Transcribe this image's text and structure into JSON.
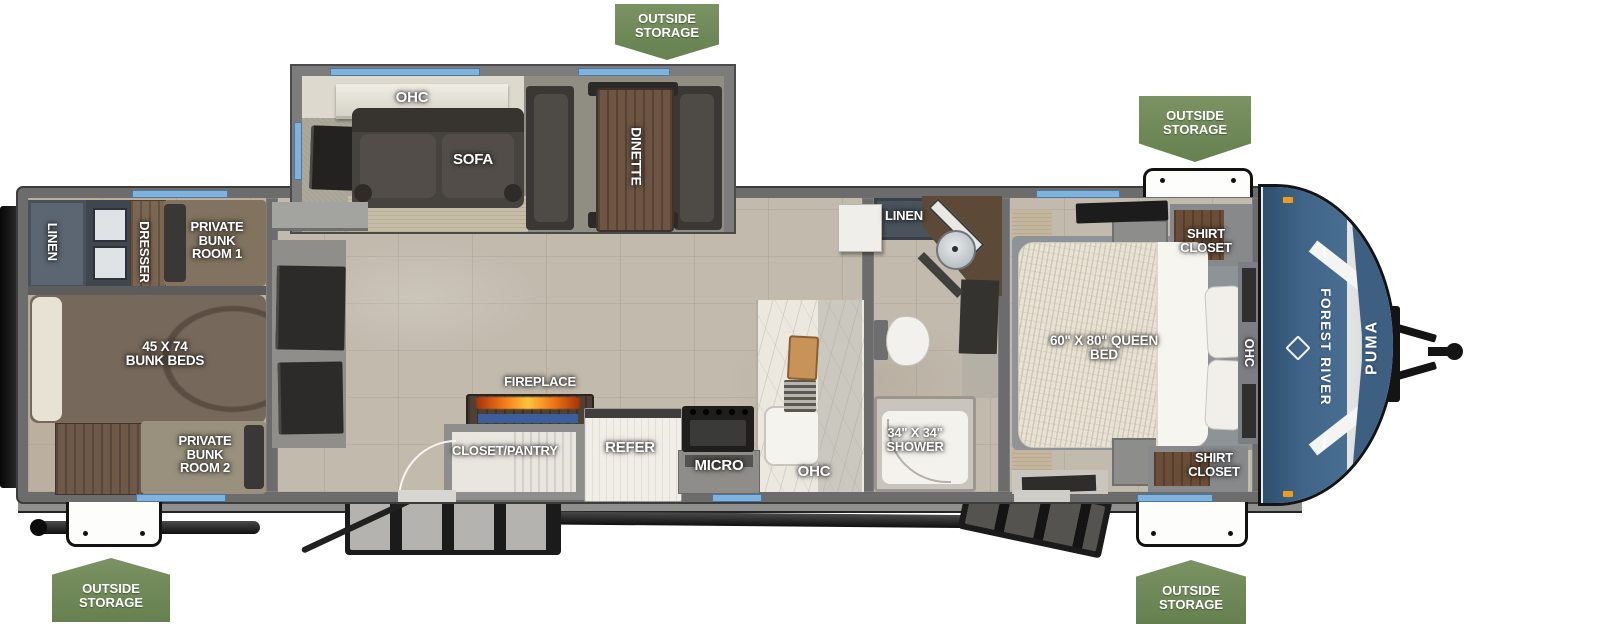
{
  "badges": {
    "top_center": "OUTSIDE STORAGE",
    "top_right": "OUTSIDE STORAGE",
    "bottom_left": "OUTSIDE STORAGE",
    "bottom_right": "OUTSIDE STORAGE"
  },
  "slide_out": {
    "ohc": "OHC",
    "sofa": "SOFA",
    "dinette": "DINETTE"
  },
  "rear_bunk_area": {
    "linen": "LINEN",
    "dresser": "DRESSER",
    "private_bunk_room_1": "PRIVATE BUNK ROOM 1",
    "bunk_beds": "45 X 74 BUNK BEDS",
    "private_bunk_room_2": "PRIVATE BUNK ROOM 2"
  },
  "kitchen": {
    "fireplace": "FIREPLACE",
    "closet_pantry": "CLOSET/PANTRY",
    "refer": "REFER",
    "micro": "MICRO",
    "ohc": "OHC"
  },
  "bathroom": {
    "linen": "LINEN",
    "shower": "34\" X 34\" SHOWER"
  },
  "bedroom": {
    "queen_bed": "60\" X 80\" QUEEN BED",
    "shirt_closet_top": "SHIRT CLOSET",
    "shirt_closet_bottom": "SHIRT CLOSET",
    "ohc": "OHC"
  },
  "front_cap": {
    "manufacturer": "FOREST RIVER",
    "model": "PUMA"
  },
  "colors": {
    "badge_green": "#71885a",
    "window_blue": "#7fb2dc",
    "cap_blue": "#3c5f82",
    "floor_tan": "#c2baad",
    "wall_gray": "#6c6c6c",
    "accent_orange": "#ef9c1d"
  }
}
